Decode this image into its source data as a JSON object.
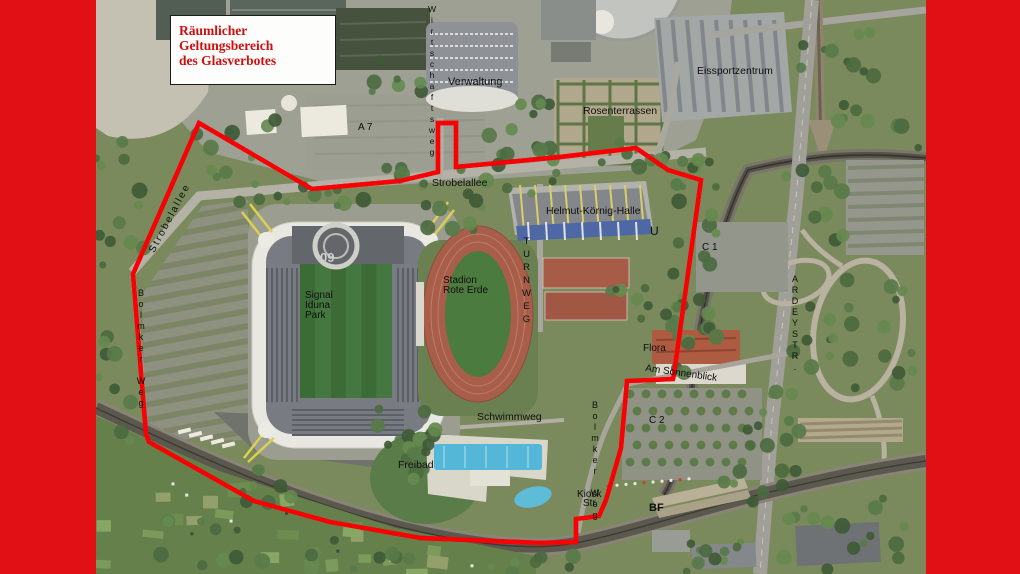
{
  "frame": {
    "side_bar_color": "#e01015"
  },
  "legend": {
    "line1": "Räumlicher Geltungsbereich",
    "line2": "des Glasverbotes"
  },
  "boundary": {
    "color": "#f90104",
    "points": "103,123 216,189 304,181 342,172 342,123 360,123 360,167 464,157 540,148 572,170 605,180 578,374 577,379 531,381 525,448 510,500 503,516 480,519 480,542 445,543 325,538 234,522 158,501 53,442 50,434 37,274"
  },
  "stadium": {
    "logo_text": "09"
  },
  "labels": {
    "verwaltung": "Verwaltung",
    "wirtschaftsweg": "Wirtschaftsweg",
    "strobelallee_top": "Strobelallee",
    "strobelallee_diag": "Strobelallee",
    "rosenterrassen": "Rosenterrassen",
    "eissportzentrum": "Eissportzentrum",
    "a7": "A 7",
    "helmut_koernig_halle": "Helmut-Körnig-Halle",
    "turnweg": "TURNWEG",
    "u_station": "U",
    "c1": "C 1",
    "signal_iduna_line1": "Signal",
    "signal_iduna_line2": "Iduna",
    "signal_iduna_line3": "Park",
    "rote_erde_line1": "Stadion",
    "rote_erde_line2": "Rote Erde",
    "flora": "Flora",
    "am_sonnenblick": "Am Sonnenblick",
    "c2": "C 2",
    "bolmker_weg_west": "Bolmker Weg",
    "bolmker_weg_east": "Bolmker Weg",
    "kiosk_line1": "Kiosk",
    "kiosk_line2": "Str.",
    "bf": "BF",
    "schwimmweg": "Schwimmweg",
    "freibad": "Freibad",
    "ardeystr": "ARDEYSTR."
  }
}
